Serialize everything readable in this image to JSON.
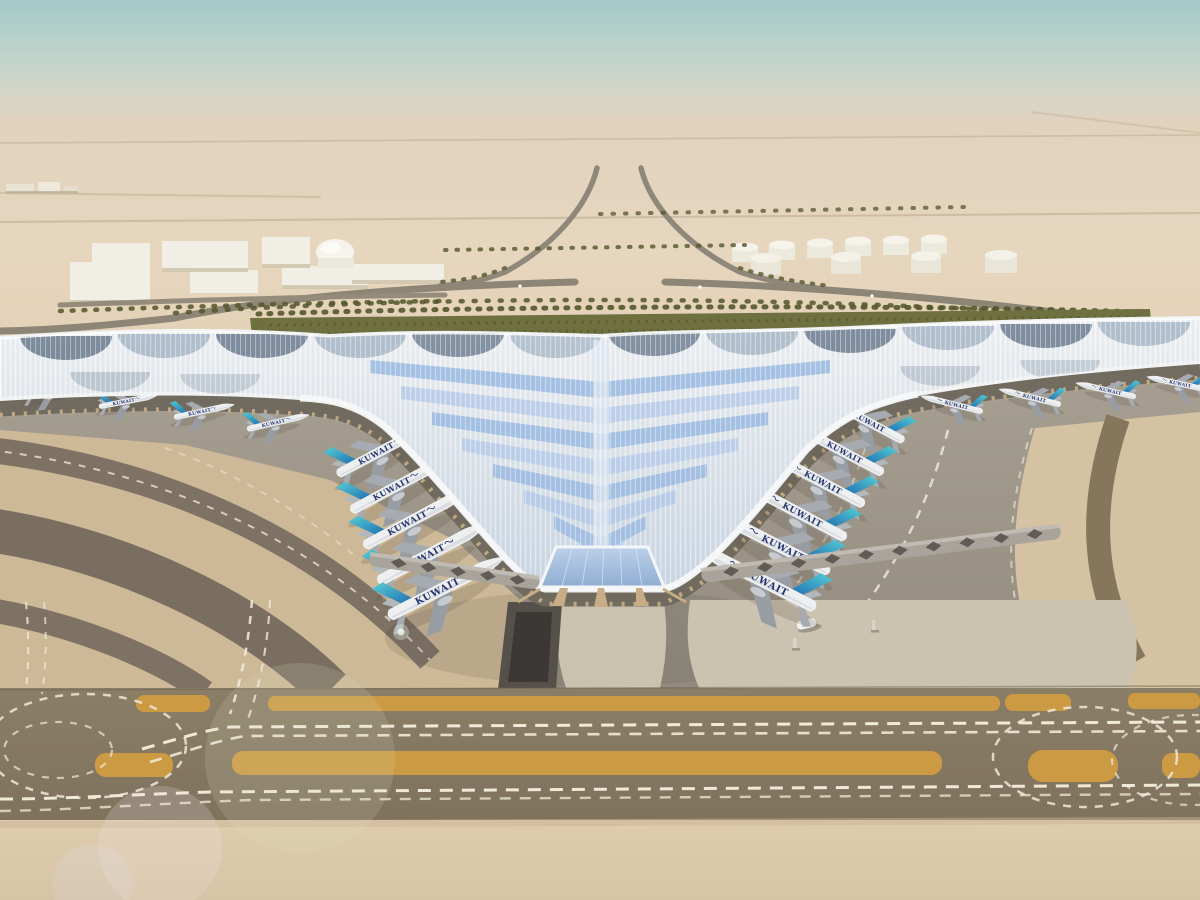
{
  "scene": {
    "kind": "aerial architectural rendering",
    "subject": "desert airport terminal with swooping trefoil roof, parked airliners, taxiways and landscaped approach"
  },
  "airline": {
    "wordmark": "KUWAIT",
    "arabic_script": "الكويتية"
  },
  "aircraft_counts": {
    "left_pier": 5,
    "right_pier": 6,
    "left_wing_row": 4,
    "right_wing_row": 4
  },
  "landside": {
    "warehouses": 7,
    "dome_buildings": 1,
    "storage_tanks": 10
  },
  "palette": {
    "sky_top": "#a7cbc8",
    "sky_haze": "#dcd5c3",
    "desert": "#e5d4bc",
    "hedge": "#6f7040",
    "palm": "#53562b",
    "road": "#8e8678",
    "building_white": "#f1eee5",
    "roof_white": "#eef0f3",
    "roof_glass": "#a3bedf",
    "roof_slate": "#5e7085",
    "facade_tan": "#c6ae88",
    "apron": "#a09888",
    "apron_shadow": "#6f685d",
    "sand_rings": "#cdb897",
    "sand_island": "#d5c2a3",
    "taxiway_band": "#877a63",
    "ochre_marking": "#cc9a43",
    "marking_white": "#efe9d8",
    "plaza": "#cac1af",
    "ramp_dark": "#55504a",
    "sand_foreground": "#dcc9ac",
    "tail_teal": "#4fc3d0",
    "tail_blue": "#1e6fb2",
    "fuselage": "#edeff1",
    "wordmark_color": "#25336f"
  }
}
